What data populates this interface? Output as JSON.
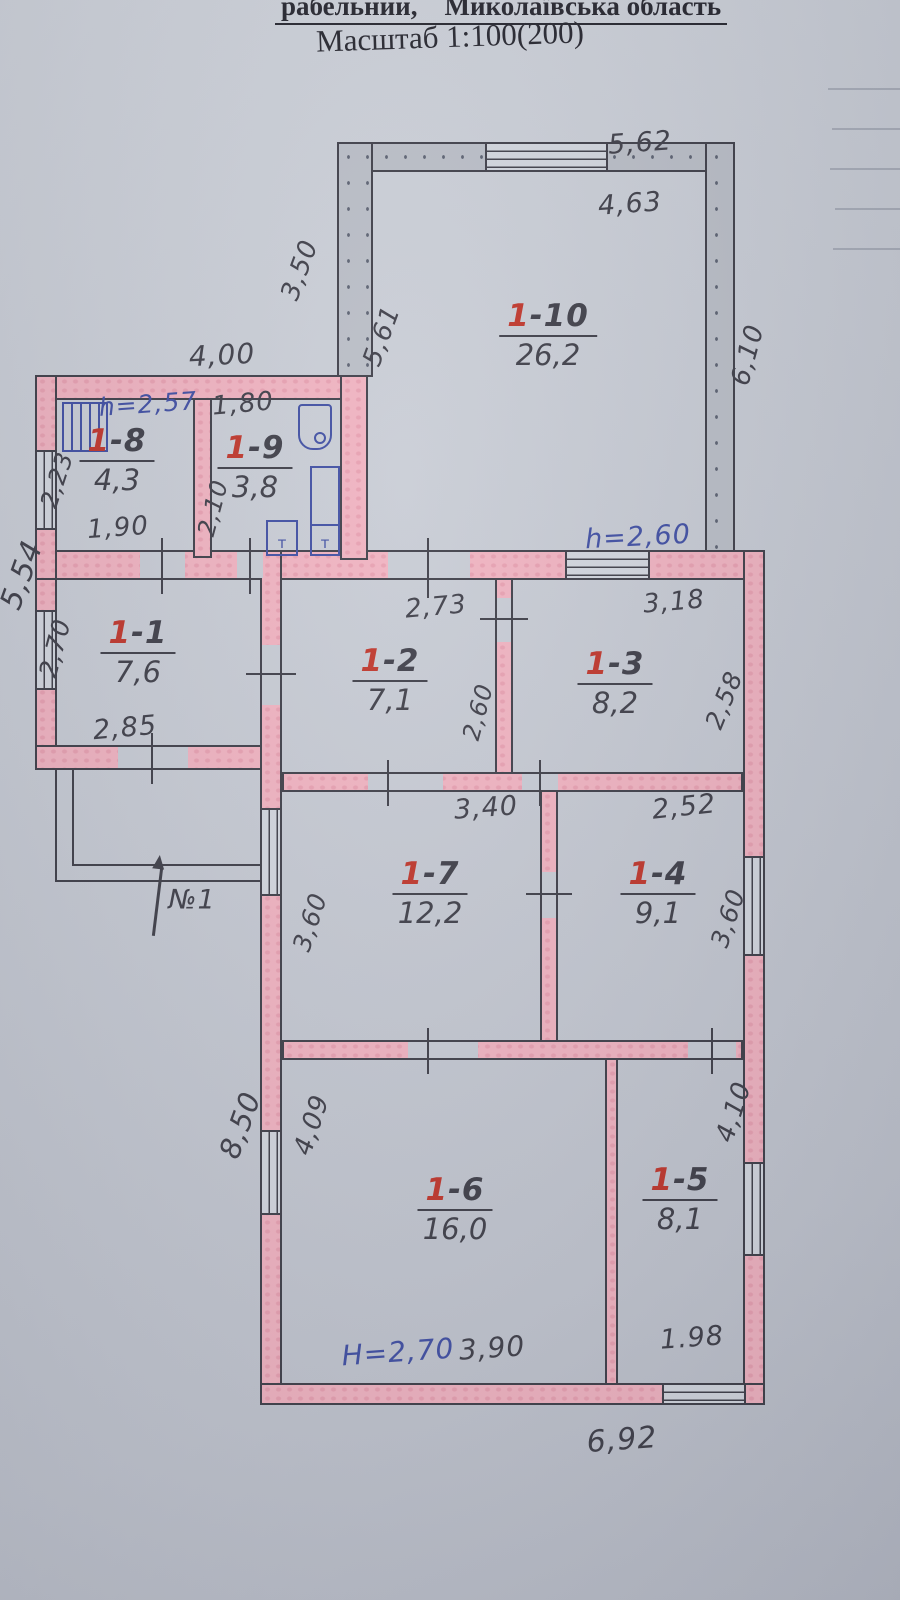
{
  "header": {
    "top_line_left": "рабельний,",
    "top_line_right": "Миколаївська область",
    "scale": "Масштаб 1:100(200)"
  },
  "colors": {
    "paper": "#c7cbd4",
    "wall_pink": "#f0b2c0",
    "wall_gray": "#b9bdc6",
    "ink": "#3d3d47",
    "red": "#bf3429",
    "blue": "#3e4da2"
  },
  "rooms": {
    "r1": {
      "no": "1",
      "dash": "-1",
      "area": "7,6"
    },
    "r2": {
      "no": "1",
      "dash": "-2",
      "area": "7,1"
    },
    "r3": {
      "no": "1",
      "dash": "-3",
      "area": "8,2"
    },
    "r4": {
      "no": "1",
      "dash": "-4",
      "area": "9,1"
    },
    "r5": {
      "no": "1",
      "dash": "-5",
      "area": "8,1"
    },
    "r6": {
      "no": "1",
      "dash": "-6",
      "area": "16,0"
    },
    "r7": {
      "no": "1",
      "dash": "-7",
      "area": "12,2"
    },
    "r8": {
      "no": "1",
      "dash": "-8",
      "area": "4,3"
    },
    "r9": {
      "no": "1",
      "dash": "-9",
      "area": "3,8"
    },
    "r10": {
      "no": "1",
      "dash": "-10",
      "area": "26,2"
    }
  },
  "dims": {
    "annex_top": "4,00",
    "r9_top": "1,80",
    "r8_left": "2,23",
    "r9_left": "2,10",
    "r8_bottom": "1,90",
    "outer_left": "5,54",
    "r1_left": "2,70",
    "r1_bottom": "2,85",
    "b10_top": "5,62",
    "b10_top_inner": "4,63",
    "b10_left_outer": "3,50",
    "b10_left_inner": "5,61",
    "b10_right": "6,10",
    "r2_top": "2,73",
    "r2_right": "2,60",
    "r3_top": "3,18",
    "r3_right": "2,58",
    "r7_top": "3,40",
    "r4_top": "2,52",
    "r7_left": "3,60",
    "r4_right": "3,60",
    "west_lower": "8,50",
    "r6_left": "4,09",
    "r5_right": "4,10",
    "r6_bottom": "3,90",
    "r5_bottom": "1.98",
    "south": "6,92",
    "door1": "№1"
  },
  "heights": {
    "r8": "h=2,57",
    "r10": "h=2,60",
    "r6": "H=2,70"
  },
  "fixtures": {
    "bath_tap": "т",
    "sink_tap": "т"
  }
}
